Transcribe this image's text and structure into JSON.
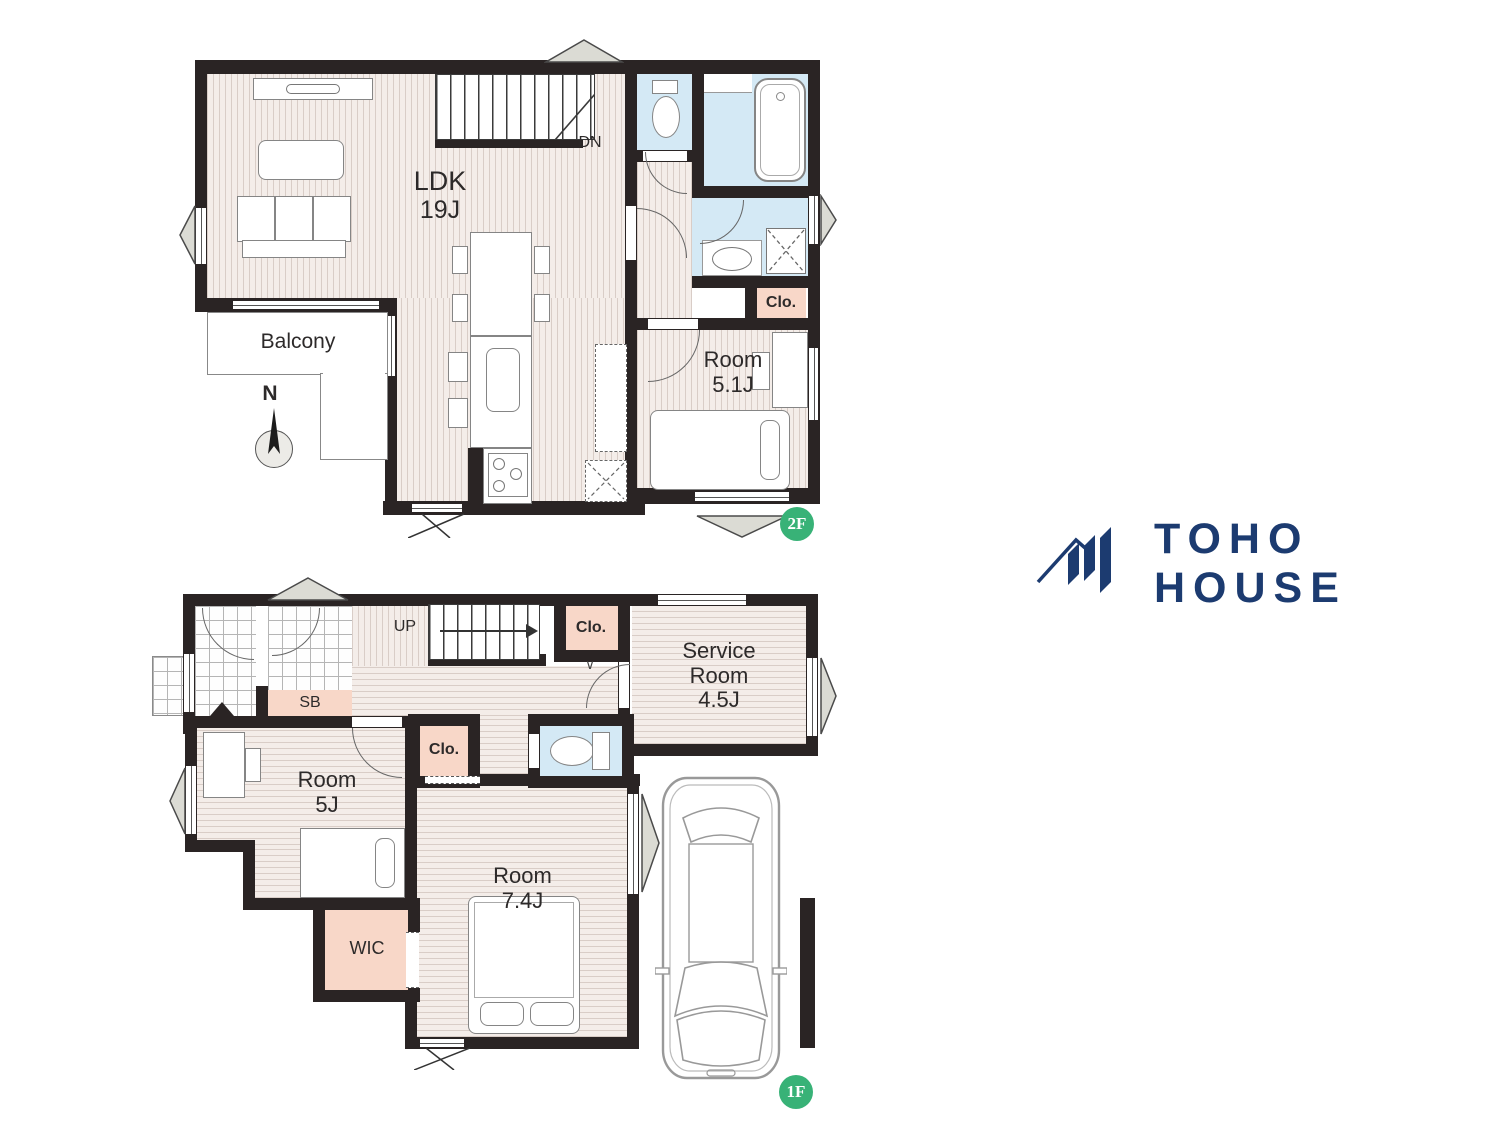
{
  "logo": {
    "name": "TOHO HOUSE",
    "color": "#1c3b70"
  },
  "floors": {
    "second": {
      "badge": "2F",
      "stairs_label": "DN",
      "compass_label": "N",
      "rooms": {
        "ldk": {
          "name": "LDK",
          "size": "19J"
        },
        "balcony": {
          "name": "Balcony"
        },
        "room51": {
          "name": "Room",
          "size": "5.1J"
        },
        "closet": {
          "label": "Clo."
        }
      }
    },
    "first": {
      "badge": "1F",
      "stairs_label": "UP",
      "rooms": {
        "service": {
          "name_line1": "Service",
          "name_line2": "Room",
          "size": "4.5J"
        },
        "room5": {
          "name": "Room",
          "size": "5J"
        },
        "room74": {
          "name": "Room",
          "size": "7.4J"
        },
        "wic": {
          "label": "WIC"
        },
        "shoe_box": {
          "label": "SB"
        },
        "closet_hall": {
          "label": "Clo."
        },
        "closet_room5": {
          "label": "Clo."
        },
        "door_mark": {
          "label": "∨"
        }
      }
    }
  },
  "colors": {
    "wall": "#2a2424",
    "floor_stripe": "#d9cdc7",
    "water_blue": "#d4e9f5",
    "closet_peach": "#f8d7c8",
    "badge_green": "#38b277",
    "logo_navy": "#1c3b70"
  }
}
